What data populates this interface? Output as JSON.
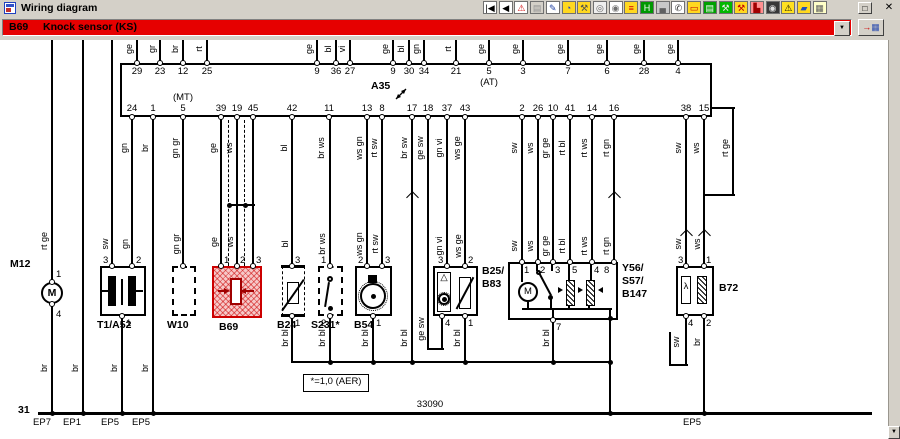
{
  "window": {
    "title": "Wiring diagram",
    "restore_glyph": "□",
    "close_glyph": "✕"
  },
  "toolbar": {
    "icons": [
      {
        "name": "first-record-icon",
        "g": "|◀",
        "fg": "#000000",
        "bg": "#ffffff"
      },
      {
        "name": "prev-record-icon",
        "g": "◀",
        "fg": "#000000",
        "bg": "#ffffff"
      },
      {
        "name": "warning-icon",
        "g": "⚠",
        "fg": "#d00000",
        "bg": "#ffffff"
      },
      {
        "name": "page-disabled-icon",
        "g": "▤",
        "fg": "#909090",
        "bg": "#d4d0c8"
      },
      {
        "name": "edit-pencil-icon",
        "g": "✎",
        "fg": "#2040a0",
        "bg": "#ffffff"
      },
      {
        "name": "gauge-icon",
        "g": "◔",
        "fg": "#2040c0",
        "bg": "#ffd820"
      },
      {
        "name": "tools-icon",
        "g": "⚒",
        "fg": "#505050",
        "bg": "#ffd820"
      },
      {
        "name": "wheel-icon",
        "g": "◎",
        "fg": "#606060",
        "bg": "#eeeeee"
      },
      {
        "name": "wheel-wrench-icon",
        "g": "◉",
        "fg": "#707070",
        "bg": "#ffffff"
      },
      {
        "name": "ramp-icon",
        "g": "≡",
        "fg": "#d00000",
        "bg": "#ffd820"
      },
      {
        "name": "lift-icon",
        "g": "H",
        "fg": "#ffffff",
        "bg": "#009800"
      },
      {
        "name": "vehicle-front-icon",
        "g": "▄",
        "fg": "#606060",
        "bg": "#c8c8c8"
      },
      {
        "name": "tester-icon",
        "g": "✆",
        "fg": "#303030",
        "bg": "#ffffff"
      },
      {
        "name": "battery-icon",
        "g": "▭",
        "fg": "#c00000",
        "bg": "#ffd820"
      },
      {
        "name": "printer-icon",
        "g": "▤",
        "fg": "#ffffff",
        "bg": "#00a000"
      },
      {
        "name": "workshop-icon",
        "g": "⚒",
        "fg": "#e8e8e8",
        "bg": "#00b800"
      },
      {
        "name": "repair-tools-icon",
        "g": "⚒",
        "fg": "#c00000",
        "bg": "#ffd820"
      },
      {
        "name": "seat-icon",
        "g": "▙",
        "fg": "#a00000",
        "bg": "#ff9090"
      },
      {
        "name": "steering-wheel-icon",
        "g": "◉",
        "fg": "#e0e0e0",
        "bg": "#383838"
      },
      {
        "name": "caution-icon",
        "g": "⚠",
        "fg": "#000000",
        "bg": "#ffe020"
      },
      {
        "name": "car-icon",
        "g": "▰",
        "fg": "#2050c0",
        "bg": "#ffd820"
      },
      {
        "name": "schedule-icon",
        "g": "▦",
        "fg": "#606060",
        "bg": "#ffffc8"
      }
    ]
  },
  "banner": {
    "code": "B69",
    "label": "Knock sensor (KS)",
    "dropdown_glyph": "▼",
    "goto_arrow": "→",
    "goto_grid": "▦"
  },
  "scrollbar": {
    "down_glyph": "▼"
  },
  "diagram": {
    "ecu_label": "A35",
    "notes": {
      "ground": "31",
      "track": "33090",
      "footnote": "*=1,0 (AER)"
    },
    "top_terminals": [
      {
        "num": "29",
        "color": "ge"
      },
      {
        "num": "23",
        "color": "gr"
      },
      {
        "num": "12",
        "color": "br"
      },
      {
        "num": "25",
        "color": "rt"
      },
      {
        "num": "9",
        "color": "ge"
      },
      {
        "num": "36",
        "color": "bl"
      },
      {
        "num": "27",
        "color": "vi"
      },
      {
        "num": "9",
        "color": "ge"
      },
      {
        "num": "30",
        "color": "bl"
      },
      {
        "num": "34",
        "color": "gn"
      },
      {
        "num": "21",
        "color": "rt"
      },
      {
        "num": "5",
        "color": "ge",
        "note": "(AT)"
      },
      {
        "num": "3",
        "color": "ge"
      },
      {
        "num": "7",
        "color": "ge"
      },
      {
        "num": "6",
        "color": "ge"
      },
      {
        "num": "28",
        "color": "ge"
      },
      {
        "num": "4",
        "color": "ge"
      }
    ],
    "bottom_terminals": [
      {
        "num": "24",
        "color": "gn"
      },
      {
        "num": "1",
        "color": "br"
      },
      {
        "num": "5",
        "color": "gn gr",
        "note": "(MT)"
      },
      {
        "num": "39",
        "color": "ge"
      },
      {
        "num": "19",
        "color": "ws"
      },
      {
        "num": "45",
        "color": ""
      },
      {
        "num": "42",
        "color": "bl"
      },
      {
        "num": "11",
        "color": "br ws"
      },
      {
        "num": "13",
        "color": "ws gn"
      },
      {
        "num": "8",
        "color": "rt sw"
      },
      {
        "num": "17",
        "color": "br sw"
      },
      {
        "num": "18",
        "color": "ge sw"
      },
      {
        "num": "37",
        "color": "gn vi"
      },
      {
        "num": "43",
        "color": "ws ge"
      },
      {
        "num": "2",
        "color": "sw"
      },
      {
        "num": "26",
        "color": "ws"
      },
      {
        "num": "10",
        "color": "gr ge"
      },
      {
        "num": "41",
        "color": "rt bl"
      },
      {
        "num": "14",
        "color": "rt ws"
      },
      {
        "num": "16",
        "color": "rt gn"
      },
      {
        "num": "38",
        "color": "sw"
      },
      {
        "num": "15",
        "color": "ws"
      }
    ],
    "component_labels": [
      "M12",
      "T1/A52",
      "W10",
      "B69",
      "B24",
      "S231*",
      "B54",
      "B25/",
      "B83",
      "Y56/",
      "S57/",
      "B147",
      "B72"
    ],
    "pins": [
      "1",
      "4",
      "3",
      "2",
      "1",
      "1",
      "2",
      "3",
      "3",
      "1",
      "1",
      "2",
      "2",
      "3",
      "1",
      "3",
      "2",
      "4",
      "1",
      "1",
      "2",
      "3",
      "5",
      "4",
      "8",
      "7",
      "3",
      "1",
      "4",
      "2"
    ],
    "extra_labels": [
      "rt ge",
      "br",
      "br",
      "sw",
      "gn",
      "br",
      "br",
      "gn gr",
      "ge",
      "ws",
      "bl",
      "br ws",
      "ws gn",
      "rt sw",
      "gn vi",
      "ws ge",
      "ge sw",
      "sw",
      "ws",
      "gr ge",
      "rt bl",
      "rt ws",
      "rt gn",
      "sw",
      "ws",
      "br bl",
      "br bl",
      "br bl",
      "br bl",
      "br bl",
      "br bl",
      "sw",
      "br",
      "rt ge"
    ],
    "eps": [
      "EP7",
      "EP1",
      "EP5",
      "EP5",
      "EP5"
    ],
    "motor_letter": "M",
    "lambda_letter": "λ",
    "triangle_glyph": "△"
  }
}
